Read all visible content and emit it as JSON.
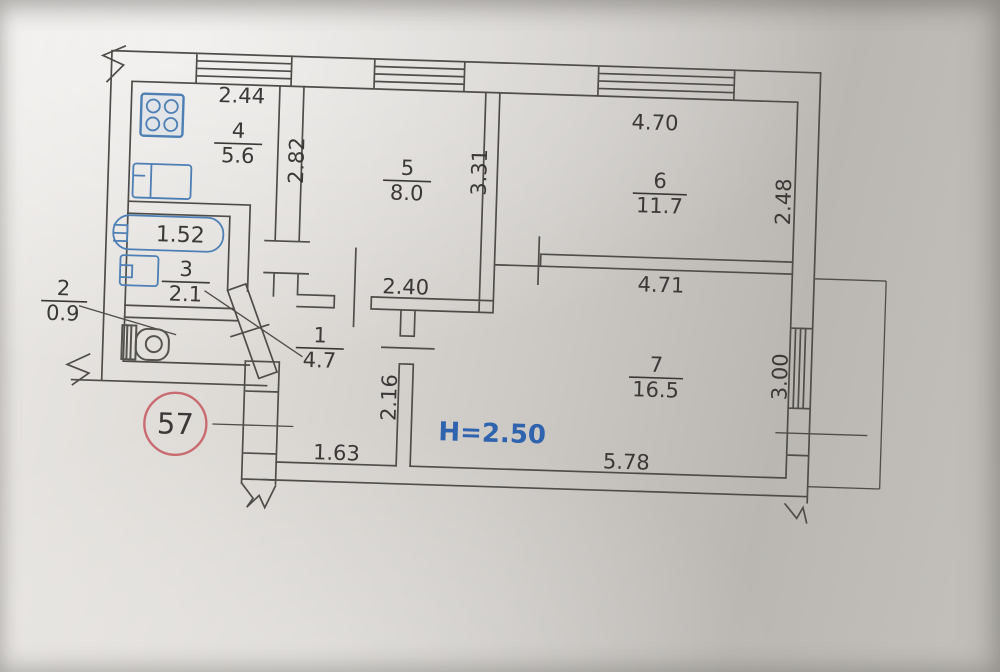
{
  "drawing": {
    "kind": "apartment floor plan",
    "annotations": {
      "ceiling_height": "H=2.50",
      "apartment_number": "57"
    },
    "rooms": {
      "r1": {
        "number": "1",
        "area": "4.7"
      },
      "r2": {
        "number": "2",
        "area": "0.9"
      },
      "r3": {
        "number": "3",
        "area": "2.1"
      },
      "r4": {
        "number": "4",
        "area": "5.6"
      },
      "r5": {
        "number": "5",
        "area": "8.0"
      },
      "r6": {
        "number": "6",
        "area": "11.7"
      },
      "r7": {
        "number": "7",
        "area": "16.5"
      }
    },
    "dimensions": {
      "kitchen_width": "2.44",
      "kitchen_depth": "2.82",
      "room5_wall_height": "3.31",
      "room5_bottom_width": "2.40",
      "room6_top_width": "4.70",
      "room6_right_height": "2.48",
      "room6_bottom_width": "4.71",
      "hall_wall_height": "2.16",
      "hall_bottom_width": "1.63",
      "room7_bottom_width": "5.78",
      "room7_right_height": "3.00",
      "bathtub_length": "1.52"
    },
    "colors": {
      "line": "#4f4d4a",
      "fixture_blue": "#4d7fb5",
      "height_note_blue": "#2f63ae",
      "stamp_red": "#c96b70",
      "text": "#3b3937"
    }
  }
}
